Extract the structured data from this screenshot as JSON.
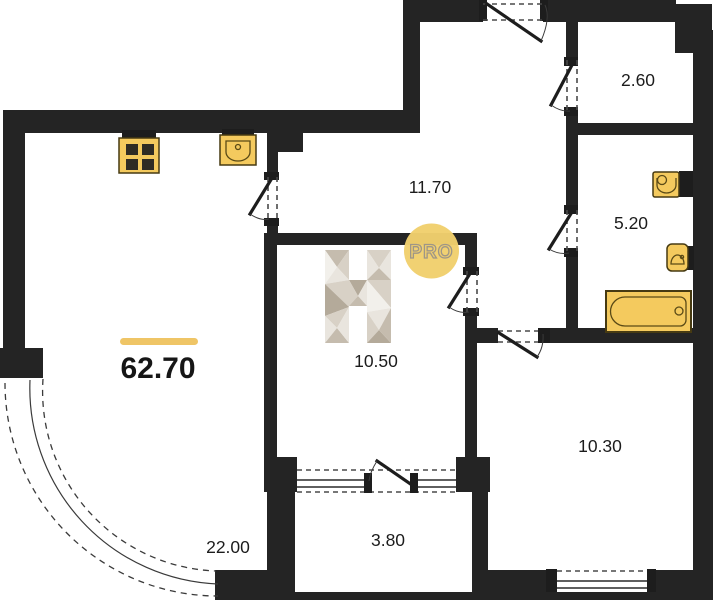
{
  "plan": {
    "total_area": {
      "value": "62.70"
    },
    "rooms": [
      {
        "id": "living-kitchen",
        "area": "22.00"
      },
      {
        "id": "hallway",
        "area": "11.70"
      },
      {
        "id": "wardrobe",
        "area": "2.60"
      },
      {
        "id": "bathroom",
        "area": "5.20"
      },
      {
        "id": "bedroom",
        "area": "10.50"
      },
      {
        "id": "room",
        "area": "10.30"
      },
      {
        "id": "balcony",
        "area": "3.80"
      }
    ],
    "watermark": {
      "letter": "H",
      "badge": "PRO"
    },
    "fixtures": [
      "stove",
      "kitchen-sink",
      "washbasin",
      "toilet",
      "bathtub"
    ],
    "colors": {
      "wall": "#242424",
      "fixture_fill": "#f4ca5e",
      "fixture_border": "#463a12",
      "accent_underline": "#efc566",
      "watermark_circle": "#f1cf6d",
      "watermark_letter_light": "#e9e5de",
      "watermark_letter_dark": "#b4aa9a"
    }
  }
}
